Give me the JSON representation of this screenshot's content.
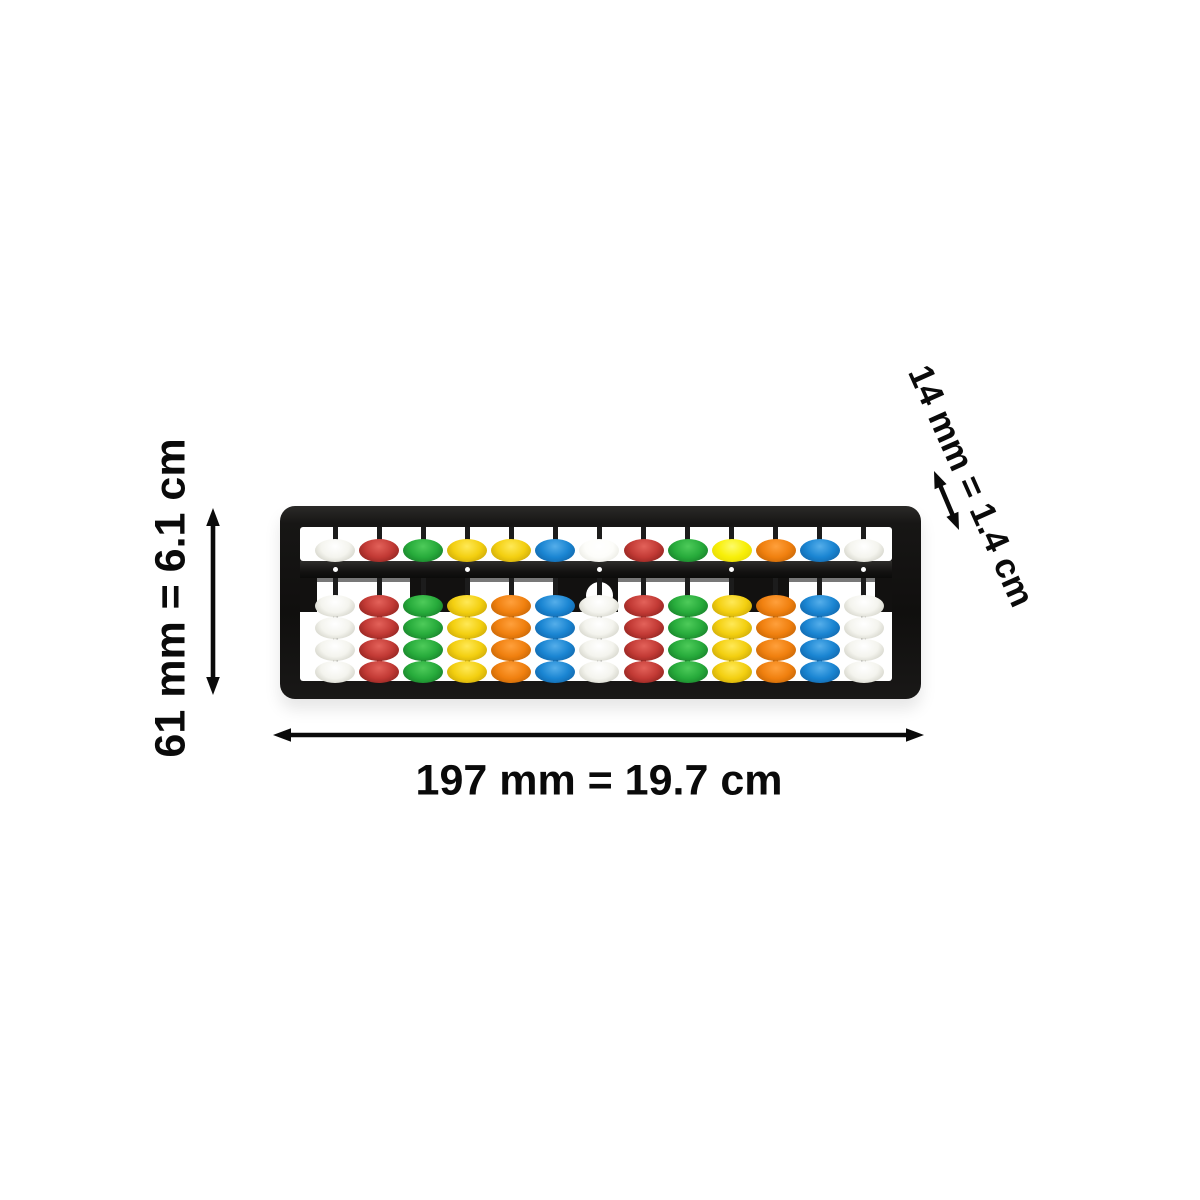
{
  "labels": {
    "height": "61 mm = 6.1 cm",
    "width": "197 mm = 19.7 cm",
    "depth": "14 mm = 1.4 cm"
  },
  "annotations": {
    "text_color": "#0a0a0a",
    "arrow_color": "#0a0a0a"
  },
  "abacus": {
    "type": "soroban-abacus",
    "columns": 13,
    "heaven_beads_per_column": 1,
    "earth_beads_per_column": 4,
    "unit_dot_columns": [
      1,
      4,
      7,
      10,
      13
    ],
    "frame_color": "#171615",
    "rod_color": "#1c1c1c",
    "beam_dot_color": "#ffffff",
    "columns_beads": [
      {
        "heaven": "white",
        "earth": "white"
      },
      {
        "heaven": "red",
        "earth": "red"
      },
      {
        "heaven": "green",
        "earth": "green"
      },
      {
        "heaven": "yellow",
        "earth": "yellow"
      },
      {
        "heaven": "yellow",
        "earth": "orange"
      },
      {
        "heaven": "blue",
        "earth": "blue"
      },
      {
        "heaven": "white_bright",
        "earth": "white"
      },
      {
        "heaven": "red",
        "earth": "red"
      },
      {
        "heaven": "green",
        "earth": "green"
      },
      {
        "heaven": "yellow_bright",
        "earth": "yellow"
      },
      {
        "heaven": "orange",
        "earth": "orange"
      },
      {
        "heaven": "blue",
        "earth": "blue"
      },
      {
        "heaven": "white",
        "earth": "white"
      }
    ],
    "palette": {
      "white": {
        "hi": "#ffffff",
        "base": "#f4f4ee",
        "shade": "#c6c6ba"
      },
      "white_bright": {
        "hi": "#ffffff",
        "base": "#fdfdfa",
        "shade": "#e3e3da"
      },
      "red": {
        "hi": "#e3625a",
        "base": "#c23a35",
        "shade": "#7c1b17"
      },
      "green": {
        "hi": "#4ecb5a",
        "base": "#27ab3b",
        "shade": "#137024"
      },
      "yellow": {
        "hi": "#ffe957",
        "base": "#f3cf10",
        "shade": "#bd9a06"
      },
      "yellow_bright": {
        "hi": "#fdfb6a",
        "base": "#f8ef08",
        "shade": "#ddd106"
      },
      "orange": {
        "hi": "#ffa03c",
        "base": "#f0800f",
        "shade": "#b55c03"
      },
      "blue": {
        "hi": "#55aeea",
        "base": "#1a85d2",
        "shade": "#0e5b9c"
      }
    }
  }
}
